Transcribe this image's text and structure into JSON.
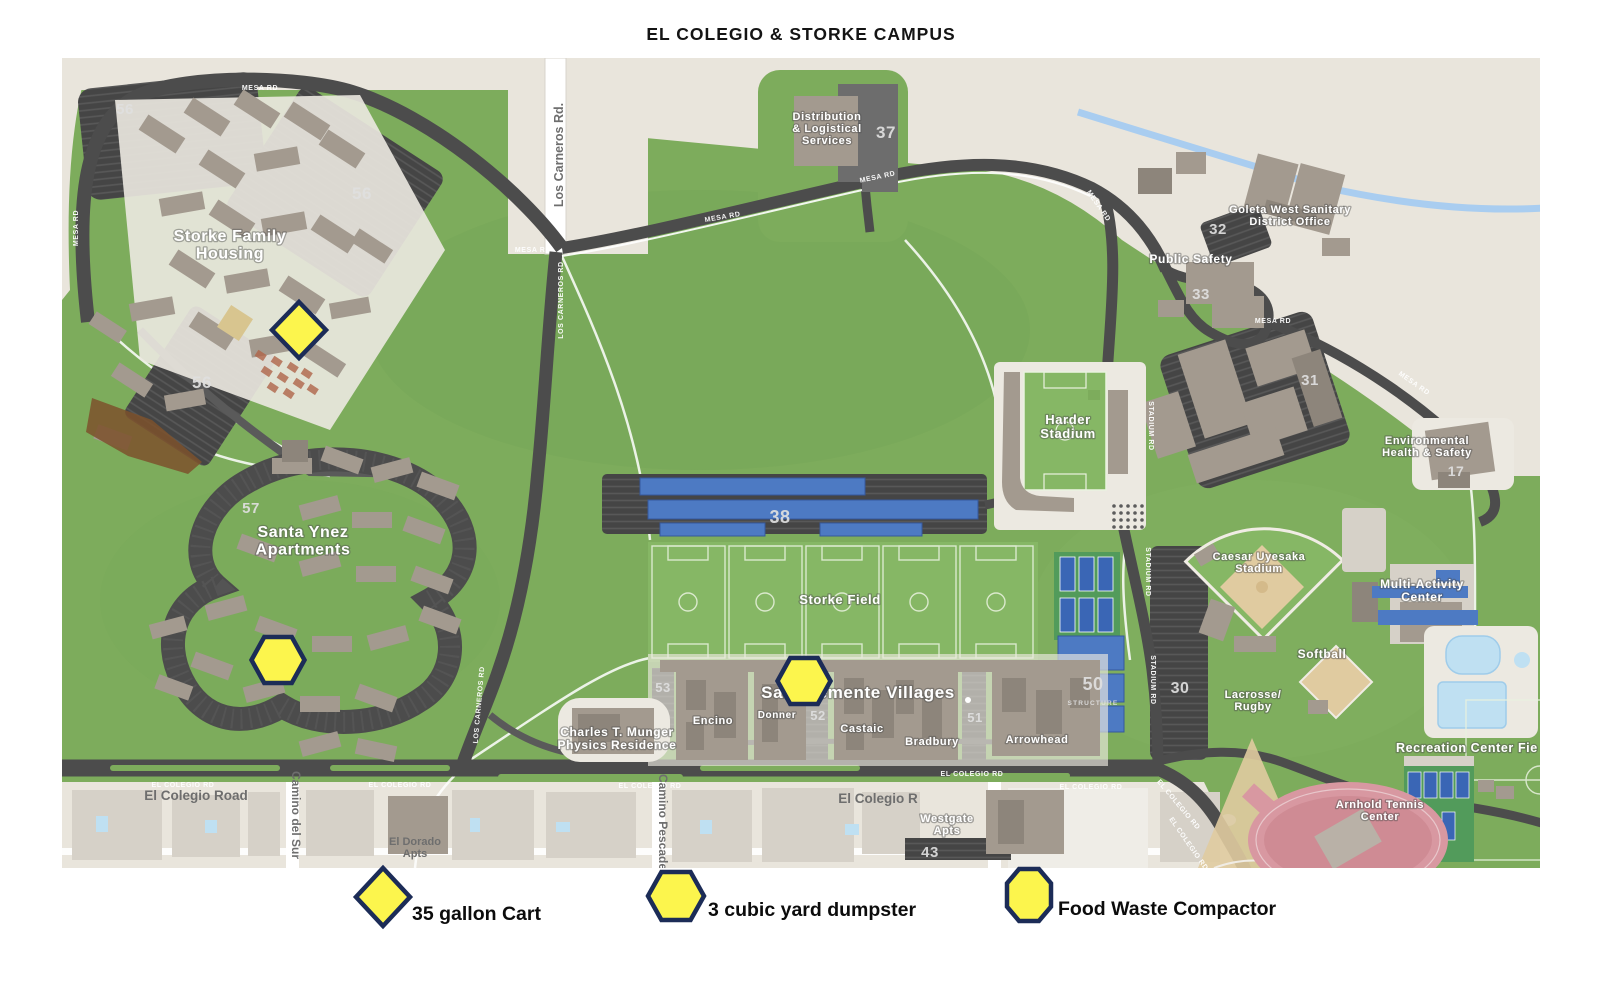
{
  "page": {
    "title": "EL COLEGIO & STORKE CAMPUS"
  },
  "colors": {
    "background": "#ffffff",
    "campus_green": "#7dac5c",
    "field_green": "#86b765",
    "offcampus_beige": "#e9e5dc",
    "road_dark": "#4c4c4c",
    "road_medium": "#5a5a5a",
    "parking_dark": "#454545",
    "building_taupe": "#a39a8f",
    "building_dark": "#8d857b",
    "building_light": "#d6d1c8",
    "pad_light": "#ece9e1",
    "solar_blue": "#4d7ac3",
    "court_blue": "#3a66b5",
    "court_pad_green": "#529b5b",
    "pool_blue": "#bfe0f2",
    "creek_blue": "#a9cdf0",
    "track_pink": "#d898a1",
    "sand_tan": "#e0cba0",
    "dirt_brown": "#7d512c",
    "garden_red": "#b0654a",
    "marker_yellow": "#fcf54d",
    "marker_navy": "#1c2c57",
    "label_white": "#ffffff",
    "label_gray": "#6e6e6e",
    "number_gray": "#e0e0e0",
    "text_dark": "#141414"
  },
  "map": {
    "place_labels": [
      {
        "id": "storke-family-housing",
        "lines": [
          "Storke Family",
          "Housing"
        ],
        "x": 230,
        "y": 241,
        "size": 16
      },
      {
        "id": "santa-ynez-apartments",
        "lines": [
          "Santa Ynez",
          "Apartments"
        ],
        "x": 303,
        "y": 537,
        "size": 16
      },
      {
        "id": "san-clemente-villages",
        "lines": [
          "San Clemente Villages"
        ],
        "x": 858,
        "y": 698,
        "size": 17
      },
      {
        "id": "storke-field",
        "lines": [
          "Storke Field"
        ],
        "x": 840,
        "y": 604,
        "size": 13
      },
      {
        "id": "harder-stadium",
        "lines": [
          "Harder",
          "Stadium"
        ],
        "x": 1068,
        "y": 424,
        "size": 13
      },
      {
        "id": "distribution-logistical-services",
        "lines": [
          "Distribution",
          "& Logistical",
          "Services"
        ],
        "x": 827,
        "y": 120,
        "size": 11
      },
      {
        "id": "goleta-west-sanitary",
        "lines": [
          "Goleta West Sanitary",
          "District Office"
        ],
        "x": 1290,
        "y": 213,
        "size": 11
      },
      {
        "id": "public-safety",
        "lines": [
          "Public Safety"
        ],
        "x": 1191,
        "y": 263,
        "size": 12
      },
      {
        "id": "environmental-health-safety",
        "lines": [
          "Environmental",
          "Health & Safety"
        ],
        "x": 1427,
        "y": 444,
        "size": 11
      },
      {
        "id": "caesar-uyesaka-stadium",
        "lines": [
          "Caesar Uyesaka",
          "Stadium"
        ],
        "x": 1259,
        "y": 560,
        "size": 11
      },
      {
        "id": "softball",
        "lines": [
          "Softball"
        ],
        "x": 1322,
        "y": 658,
        "size": 12
      },
      {
        "id": "lacrosse-rugby",
        "lines": [
          "Lacrosse/",
          "Rugby"
        ],
        "x": 1253,
        "y": 698,
        "size": 11
      },
      {
        "id": "multi-activity-center",
        "lines": [
          "Multi-Activity",
          "Center"
        ],
        "x": 1422,
        "y": 588,
        "size": 12
      },
      {
        "id": "recreation-center-fields",
        "lines": [
          "Recreation Center Fie"
        ],
        "x": 1396,
        "y": 752,
        "size": 12.5,
        "anchor": "start"
      },
      {
        "id": "arnhold-tennis-center",
        "lines": [
          "Arnhold Tennis",
          "Center"
        ],
        "x": 1380,
        "y": 808,
        "size": 11
      },
      {
        "id": "munger-physics-residence",
        "lines": [
          "Charles T. Munger",
          "Physics Residence"
        ],
        "x": 617,
        "y": 736,
        "size": 12
      },
      {
        "id": "encino",
        "lines": [
          "Encino"
        ],
        "x": 713,
        "y": 724,
        "size": 11
      },
      {
        "id": "donner",
        "lines": [
          "Donner"
        ],
        "x": 777,
        "y": 718,
        "size": 10
      },
      {
        "id": "castaic",
        "lines": [
          "Castaic"
        ],
        "x": 862,
        "y": 732,
        "size": 11
      },
      {
        "id": "bradbury",
        "lines": [
          "Bradbury"
        ],
        "x": 932,
        "y": 745,
        "size": 11
      },
      {
        "id": "arrowhead",
        "lines": [
          "Arrowhead"
        ],
        "x": 1037,
        "y": 743,
        "size": 11
      },
      {
        "id": "westgate-apts",
        "lines": [
          "Westgate",
          "Apts"
        ],
        "x": 947,
        "y": 822,
        "size": 11
      }
    ],
    "gray_labels": [
      {
        "id": "el-dorado-apts",
        "lines": [
          "El Dorado",
          "Apts"
        ],
        "x": 415,
        "y": 845,
        "size": 11
      },
      {
        "id": "el-colegio-road-name",
        "lines": [
          "El Colegio Road"
        ],
        "x": 196,
        "y": 800,
        "size": 13.5
      },
      {
        "id": "el-colegio-r-name",
        "lines": [
          "El Colegio R"
        ],
        "x": 878,
        "y": 803,
        "size": 13.5
      },
      {
        "id": "camino-del-sur-name",
        "lines": [
          "Camino del Sur"
        ],
        "x": 292,
        "y": 815,
        "size": 12,
        "rot": 90
      },
      {
        "id": "camino-pescadero-name",
        "lines": [
          "Camino Pescadero"
        ],
        "x": 659,
        "y": 828,
        "size": 12,
        "rot": 90
      },
      {
        "id": "los-carneros-rd-name",
        "lines": [
          "Los Carneros Rd."
        ],
        "x": 563,
        "y": 155,
        "size": 12.5,
        "rot": -90
      }
    ],
    "road_labels": [
      {
        "text": "MESA RD",
        "x": 260,
        "y": 90,
        "rot": 0
      },
      {
        "text": "MESA RD",
        "x": 533,
        "y": 252,
        "rot": 0
      },
      {
        "text": "MESA RD",
        "x": 723,
        "y": 219,
        "rot": -10
      },
      {
        "text": "MESA RD",
        "x": 878,
        "y": 179,
        "rot": -12
      },
      {
        "text": "MESA RD",
        "x": 1273,
        "y": 323,
        "rot": 0
      },
      {
        "text": "MESA RD",
        "x": 78,
        "y": 228,
        "rot": -90
      },
      {
        "text": "MESA RD",
        "x": 1097,
        "y": 207,
        "rot": 55
      },
      {
        "text": "MESA RD",
        "x": 1413,
        "y": 385,
        "rot": 35
      },
      {
        "text": "LOS CARNEROS RD",
        "x": 563,
        "y": 300,
        "rot": -90
      },
      {
        "text": "LOS CARNEROS RD",
        "x": 481,
        "y": 705,
        "rot": -85
      },
      {
        "text": "STADIUM RD",
        "x": 1149,
        "y": 426,
        "rot": 90
      },
      {
        "text": "STADIUM RD",
        "x": 1146,
        "y": 572,
        "rot": 90
      },
      {
        "text": "STADIUM RD",
        "x": 1151,
        "y": 680,
        "rot": 90
      },
      {
        "text": "EL COLEGIO RD",
        "x": 183,
        "y": 787,
        "rot": 0
      },
      {
        "text": "EL COLEGIO RD",
        "x": 400,
        "y": 787,
        "rot": 0
      },
      {
        "text": "EL COLEGIO RD",
        "x": 650,
        "y": 788,
        "rot": 0
      },
      {
        "text": "EL COLEGIO RD",
        "x": 972,
        "y": 776,
        "rot": 0
      },
      {
        "text": "EL COLEGIO RD",
        "x": 1091,
        "y": 789,
        "rot": 0
      },
      {
        "text": "EL COLEGIO RD",
        "x": 1177,
        "y": 806,
        "rot": 50
      },
      {
        "text": "EL COLEGIO RD",
        "x": 1187,
        "y": 845,
        "rot": 55
      }
    ],
    "lot_numbers": [
      {
        "text": "56",
        "x": 125,
        "y": 114,
        "size": 15
      },
      {
        "text": "56",
        "x": 362,
        "y": 199,
        "size": 17
      },
      {
        "text": "56",
        "x": 202,
        "y": 388,
        "size": 17
      },
      {
        "text": "57",
        "x": 251,
        "y": 513,
        "size": 15
      },
      {
        "text": "37",
        "x": 886,
        "y": 138,
        "size": 17
      },
      {
        "text": "32",
        "x": 1218,
        "y": 234,
        "size": 15
      },
      {
        "text": "33",
        "x": 1201,
        "y": 299,
        "size": 15
      },
      {
        "text": "31",
        "x": 1310,
        "y": 385,
        "size": 15
      },
      {
        "text": "17",
        "x": 1456,
        "y": 476,
        "size": 14
      },
      {
        "text": "38",
        "x": 780,
        "y": 523,
        "size": 18
      },
      {
        "text": "30",
        "x": 1180,
        "y": 693,
        "size": 16
      },
      {
        "text": "50",
        "x": 1093,
        "y": 690,
        "size": 18
      },
      {
        "text": "STRUCTURE",
        "x": 1093,
        "y": 705,
        "size": 6.5
      },
      {
        "text": "53",
        "x": 663,
        "y": 692,
        "size": 13
      },
      {
        "text": "52",
        "x": 818,
        "y": 720,
        "size": 13
      },
      {
        "text": "51",
        "x": 975,
        "y": 722,
        "size": 13
      },
      {
        "text": "43",
        "x": 930,
        "y": 857,
        "size": 15
      }
    ],
    "markers": [
      {
        "shape": "diamond",
        "meaning": "35 gallon Cart",
        "location": "Storke Family Housing",
        "x": 299,
        "y": 330
      },
      {
        "shape": "hexagon",
        "meaning": "3 cubic yard dumpster",
        "location": "Santa Ynez Apartments",
        "x": 278,
        "y": 660
      },
      {
        "shape": "hexagon",
        "meaning": "3 cubic yard dumpster",
        "location": "San Clemente Villages",
        "x": 804,
        "y": 681
      }
    ]
  },
  "legend": {
    "items": [
      {
        "shape": "diamond",
        "label": "35 gallon Cart",
        "x": 383,
        "y": 897,
        "tx": 412,
        "ty": 920
      },
      {
        "shape": "hexagon",
        "label": "3 cubic yard dumpster",
        "x": 676,
        "y": 896,
        "tx": 708,
        "ty": 916
      },
      {
        "shape": "octagon",
        "label": "Food Waste Compactor",
        "x": 1029,
        "y": 895,
        "tx": 1058,
        "ty": 915
      }
    ]
  }
}
